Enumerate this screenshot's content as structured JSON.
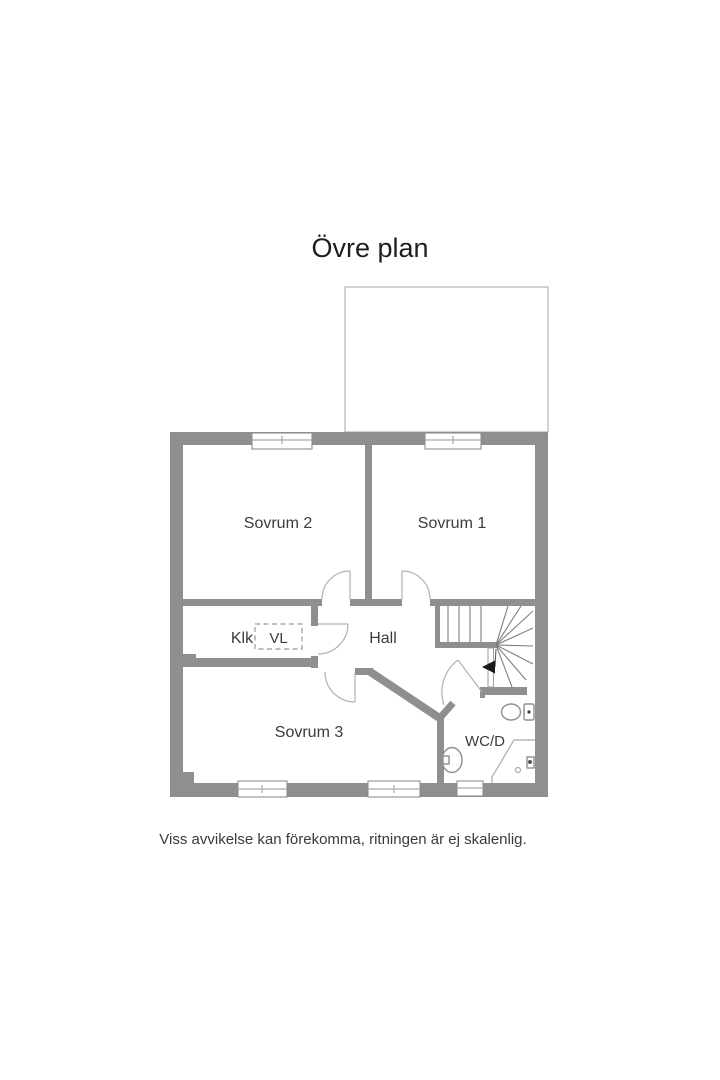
{
  "title": "Övre plan",
  "disclaimer": "Viss avvikelse kan förekomma, ritningen är ej skalenlig.",
  "rooms": {
    "sovrum1": "Sovrum 1",
    "sovrum2": "Sovrum 2",
    "sovrum3": "Sovrum 3",
    "hall": "Hall",
    "klk": "Klk",
    "vl": "VL",
    "wcd": "WC/D"
  },
  "colors": {
    "background": "#ffffff",
    "wall": "#8d8f90",
    "thin_line": "#a9abac",
    "label_text": "#3c3c3c",
    "title_text": "#1e1e1e",
    "arrow": "#1a1a1a"
  }
}
